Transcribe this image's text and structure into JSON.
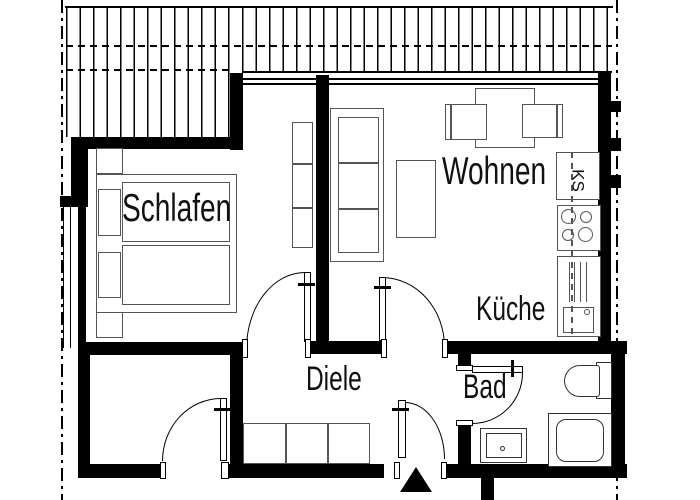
{
  "plan": {
    "type": "apartment-floor-plan",
    "labels": {
      "bedroom": "Schlafen",
      "living": "Wohnen",
      "kitchen": "Küche",
      "hall": "Diele",
      "bath": "Bad",
      "fridge": "KS"
    },
    "colors": {
      "wall": "#000000",
      "furniture_outline": "#555555",
      "fixture_outline": "#333333",
      "background": "#ffffff"
    }
  }
}
